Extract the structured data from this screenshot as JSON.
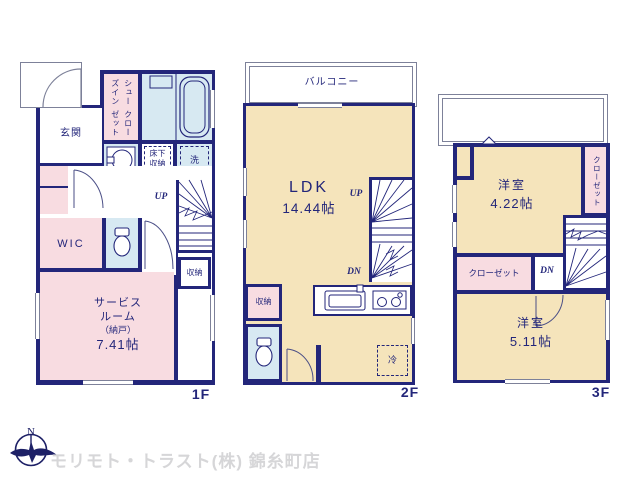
{
  "colors": {
    "wall_navy": "#23267a",
    "room_pink": "#f8dce1",
    "room_cream": "#f5e4bb",
    "room_lightblue": "#d7e9f2",
    "thin_gray": "#7d8199",
    "footer_gray": "#d6d6d8"
  },
  "floors": {
    "f1": {
      "label": "1F",
      "entrance": "玄関",
      "shoes_in_closet": [
        "シューズイン",
        "クローゼット"
      ],
      "underfloor_storage": [
        "床下",
        "収納"
      ],
      "laundry": "洗",
      "up": "UP",
      "wic": "WIC",
      "storage": "収納",
      "service_room": [
        "サービス",
        "ルーム",
        "（納戸）",
        "7.41帖"
      ]
    },
    "f2": {
      "label": "2F",
      "balcony": "バルコニー",
      "ldk": [
        "LDK",
        "14.44帖"
      ],
      "up": "UP",
      "dn": "DN",
      "storage": "収納",
      "fridge": "冷"
    },
    "f3": {
      "label": "3F",
      "room_a": [
        "洋室",
        "4.22帖"
      ],
      "closet_right": "クローゼット",
      "closet_left": "クローゼット",
      "dn": "DN",
      "room_b": [
        "洋室",
        "5.11帖"
      ]
    }
  },
  "footer": {
    "compass_north": "N",
    "agency": "モリモト・トラスト(株) 錦糸町店"
  }
}
